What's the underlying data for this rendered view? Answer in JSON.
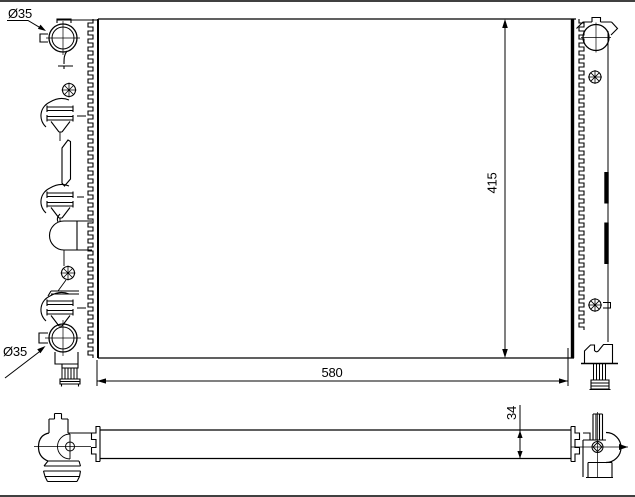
{
  "drawing": {
    "background_color": "#ffffff",
    "line_color": "#000000",
    "views": {
      "front_view": {
        "labels": {
          "inlet_diameter": "Ø35",
          "outlet_diameter": "Ø35",
          "height": "415",
          "width": "580"
        }
      },
      "bottom_view": {
        "labels": {
          "depth": "34"
        }
      }
    }
  }
}
